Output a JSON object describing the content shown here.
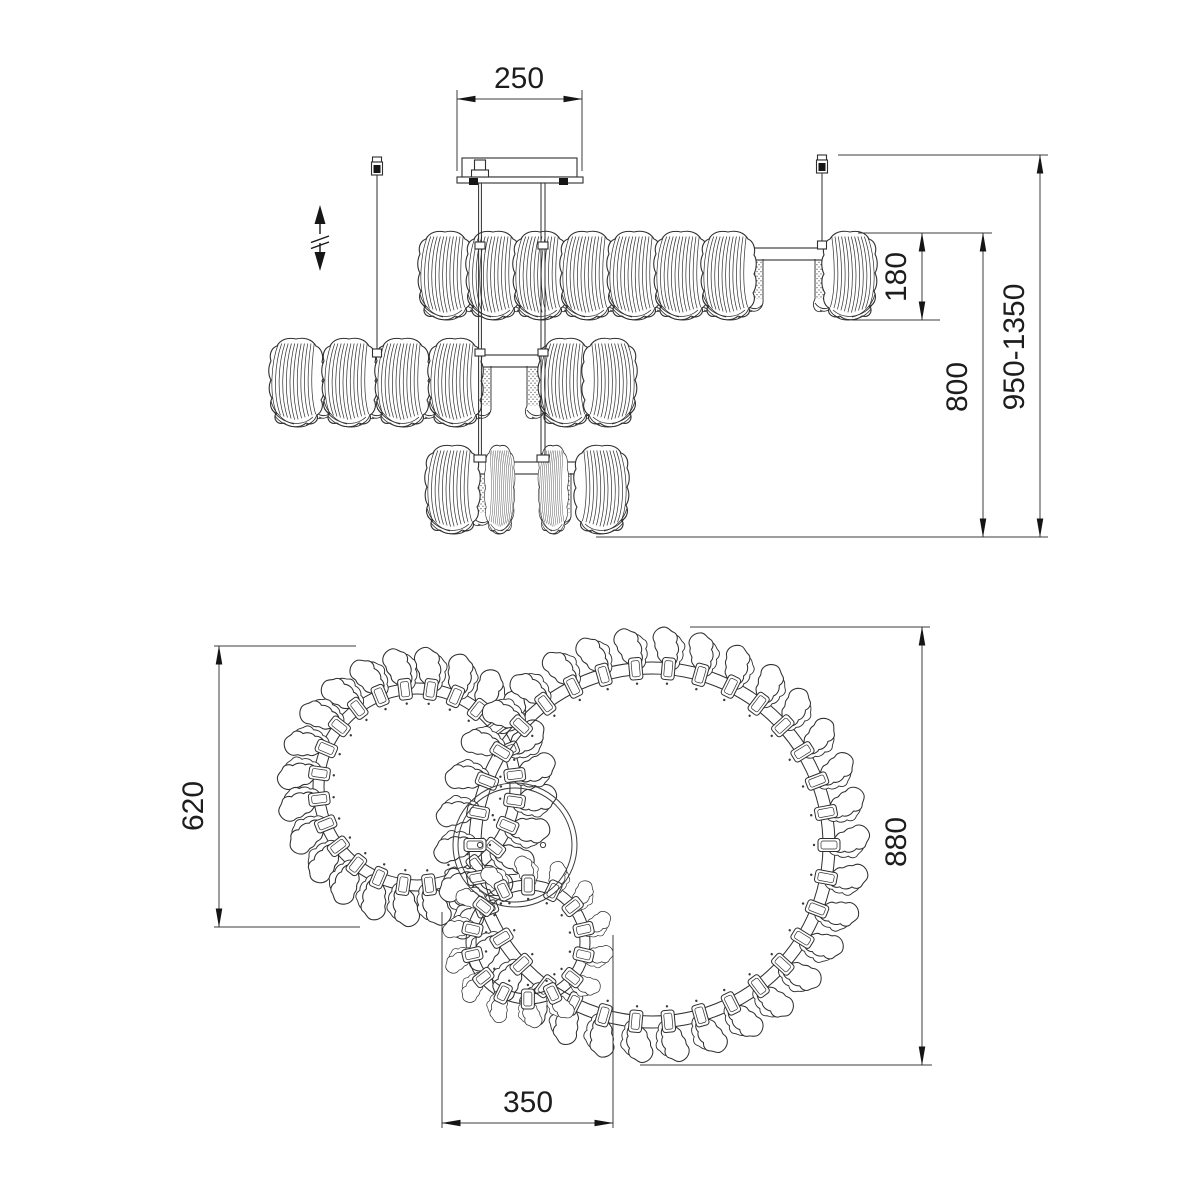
{
  "dimensions": {
    "canopy_width": "250",
    "shade_row_height": "180",
    "frame_drop": "800",
    "overall_height_range": "950-1350",
    "left_ring_diameter": "620",
    "large_ring_diameter": "880",
    "small_ring_diameter": "350"
  },
  "colors": {
    "background": "#ffffff",
    "line": "#2e2e2e",
    "dimension_line": "#3c3c3c",
    "text": "#1d1d1d"
  }
}
